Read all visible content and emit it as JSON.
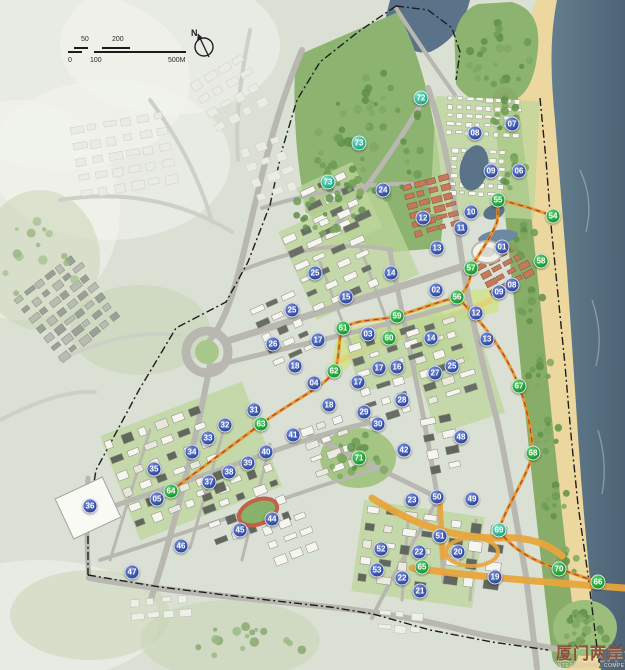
{
  "scalebar": {
    "top_labels": [
      "50",
      "200"
    ],
    "bottom_labels": [
      "0",
      "100",
      "500M"
    ]
  },
  "compass": {
    "label": "N"
  },
  "watermark": {
    "cn": "厦门两岸金融",
    "en": "INTERNATIONAL COMPETITION O"
  },
  "marker_colors": {
    "blue": "#2e4aa0",
    "green": "#179a2e",
    "teal": "#1fa887"
  },
  "map_colors": {
    "sea": "#56707f",
    "beach": "#ecd89f",
    "park": "#8cb370",
    "axis": "#d2e292",
    "road": "#b8b8b0",
    "orange_road": "#e8a53c",
    "red_roof": "#c47a5a"
  },
  "markers": [
    {
      "n": "01",
      "x": 502,
      "y": 247,
      "c": "b"
    },
    {
      "n": "02",
      "x": 436,
      "y": 290,
      "c": "b"
    },
    {
      "n": "03",
      "x": 368,
      "y": 334,
      "c": "b"
    },
    {
      "n": "04",
      "x": 314,
      "y": 383,
      "c": "b"
    },
    {
      "n": "05",
      "x": 157,
      "y": 499,
      "c": "b"
    },
    {
      "n": "06",
      "x": 519,
      "y": 171,
      "c": "b"
    },
    {
      "n": "07",
      "x": 512,
      "y": 124,
      "c": "b"
    },
    {
      "n": "08",
      "x": 475,
      "y": 133,
      "c": "b"
    },
    {
      "n": "08",
      "x": 512,
      "y": 285,
      "c": "b"
    },
    {
      "n": "09",
      "x": 491,
      "y": 171,
      "c": "b"
    },
    {
      "n": "09",
      "x": 499,
      "y": 292,
      "c": "b"
    },
    {
      "n": "10",
      "x": 471,
      "y": 212,
      "c": "b"
    },
    {
      "n": "11",
      "x": 461,
      "y": 228,
      "c": "b"
    },
    {
      "n": "12",
      "x": 423,
      "y": 218,
      "c": "b"
    },
    {
      "n": "12",
      "x": 476,
      "y": 313,
      "c": "b"
    },
    {
      "n": "13",
      "x": 437,
      "y": 248,
      "c": "b"
    },
    {
      "n": "13",
      "x": 487,
      "y": 339,
      "c": "b"
    },
    {
      "n": "14",
      "x": 391,
      "y": 273,
      "c": "b"
    },
    {
      "n": "14",
      "x": 431,
      "y": 338,
      "c": "b"
    },
    {
      "n": "15",
      "x": 346,
      "y": 297,
      "c": "b"
    },
    {
      "n": "16",
      "x": 397,
      "y": 367,
      "c": "b"
    },
    {
      "n": "17",
      "x": 318,
      "y": 340,
      "c": "b"
    },
    {
      "n": "17",
      "x": 379,
      "y": 368,
      "c": "b"
    },
    {
      "n": "17",
      "x": 358,
      "y": 382,
      "c": "b"
    },
    {
      "n": "18",
      "x": 295,
      "y": 366,
      "c": "b"
    },
    {
      "n": "18",
      "x": 329,
      "y": 405,
      "c": "b"
    },
    {
      "n": "19",
      "x": 495,
      "y": 577,
      "c": "b"
    },
    {
      "n": "20",
      "x": 458,
      "y": 552,
      "c": "b"
    },
    {
      "n": "21",
      "x": 420,
      "y": 591,
      "c": "b"
    },
    {
      "n": "22",
      "x": 419,
      "y": 552,
      "c": "b"
    },
    {
      "n": "22",
      "x": 402,
      "y": 578,
      "c": "b"
    },
    {
      "n": "23",
      "x": 412,
      "y": 500,
      "c": "b"
    },
    {
      "n": "24",
      "x": 383,
      "y": 190,
      "c": "b"
    },
    {
      "n": "25",
      "x": 315,
      "y": 273,
      "c": "b"
    },
    {
      "n": "25",
      "x": 292,
      "y": 310,
      "c": "b"
    },
    {
      "n": "25",
      "x": 452,
      "y": 366,
      "c": "b"
    },
    {
      "n": "26",
      "x": 273,
      "y": 344,
      "c": "b"
    },
    {
      "n": "27",
      "x": 435,
      "y": 373,
      "c": "b"
    },
    {
      "n": "28",
      "x": 402,
      "y": 400,
      "c": "b"
    },
    {
      "n": "29",
      "x": 364,
      "y": 412,
      "c": "b"
    },
    {
      "n": "30",
      "x": 378,
      "y": 424,
      "c": "b"
    },
    {
      "n": "31",
      "x": 254,
      "y": 410,
      "c": "b"
    },
    {
      "n": "32",
      "x": 225,
      "y": 425,
      "c": "b"
    },
    {
      "n": "33",
      "x": 208,
      "y": 438,
      "c": "b"
    },
    {
      "n": "34",
      "x": 192,
      "y": 452,
      "c": "b"
    },
    {
      "n": "35",
      "x": 154,
      "y": 469,
      "c": "b"
    },
    {
      "n": "36",
      "x": 90,
      "y": 506,
      "c": "b"
    },
    {
      "n": "37",
      "x": 209,
      "y": 482,
      "c": "b"
    },
    {
      "n": "38",
      "x": 229,
      "y": 472,
      "c": "b"
    },
    {
      "n": "39",
      "x": 248,
      "y": 463,
      "c": "b"
    },
    {
      "n": "40",
      "x": 266,
      "y": 452,
      "c": "b"
    },
    {
      "n": "41",
      "x": 293,
      "y": 435,
      "c": "b"
    },
    {
      "n": "42",
      "x": 404,
      "y": 450,
      "c": "b"
    },
    {
      "n": "44",
      "x": 272,
      "y": 519,
      "c": "b"
    },
    {
      "n": "45",
      "x": 240,
      "y": 530,
      "c": "b"
    },
    {
      "n": "46",
      "x": 181,
      "y": 546,
      "c": "b"
    },
    {
      "n": "47",
      "x": 132,
      "y": 572,
      "c": "b"
    },
    {
      "n": "48",
      "x": 461,
      "y": 437,
      "c": "b"
    },
    {
      "n": "49",
      "x": 472,
      "y": 499,
      "c": "b"
    },
    {
      "n": "50",
      "x": 437,
      "y": 497,
      "c": "b"
    },
    {
      "n": "51",
      "x": 440,
      "y": 536,
      "c": "b"
    },
    {
      "n": "52",
      "x": 381,
      "y": 549,
      "c": "b"
    },
    {
      "n": "53",
      "x": 377,
      "y": 570,
      "c": "b"
    },
    {
      "n": "54",
      "x": 553,
      "y": 216,
      "c": "g"
    },
    {
      "n": "55",
      "x": 498,
      "y": 200,
      "c": "g"
    },
    {
      "n": "56",
      "x": 457,
      "y": 297,
      "c": "g"
    },
    {
      "n": "57",
      "x": 471,
      "y": 268,
      "c": "g"
    },
    {
      "n": "58",
      "x": 541,
      "y": 261,
      "c": "g"
    },
    {
      "n": "59",
      "x": 397,
      "y": 316,
      "c": "g"
    },
    {
      "n": "60",
      "x": 389,
      "y": 338,
      "c": "g"
    },
    {
      "n": "61",
      "x": 343,
      "y": 328,
      "c": "g"
    },
    {
      "n": "62",
      "x": 334,
      "y": 371,
      "c": "g"
    },
    {
      "n": "63",
      "x": 261,
      "y": 424,
      "c": "g"
    },
    {
      "n": "64",
      "x": 171,
      "y": 491,
      "c": "g"
    },
    {
      "n": "65",
      "x": 422,
      "y": 567,
      "c": "g"
    },
    {
      "n": "66",
      "x": 598,
      "y": 582,
      "c": "g"
    },
    {
      "n": "67",
      "x": 519,
      "y": 386,
      "c": "g"
    },
    {
      "n": "68",
      "x": 533,
      "y": 453,
      "c": "g"
    },
    {
      "n": "70",
      "x": 559,
      "y": 569,
      "c": "g"
    },
    {
      "n": "71",
      "x": 359,
      "y": 458,
      "c": "g"
    },
    {
      "n": "69",
      "x": 499,
      "y": 530,
      "c": "t"
    },
    {
      "n": "72",
      "x": 421,
      "y": 98,
      "c": "t"
    },
    {
      "n": "73",
      "x": 359,
      "y": 143,
      "c": "t"
    },
    {
      "n": "73",
      "x": 328,
      "y": 182,
      "c": "t"
    }
  ]
}
